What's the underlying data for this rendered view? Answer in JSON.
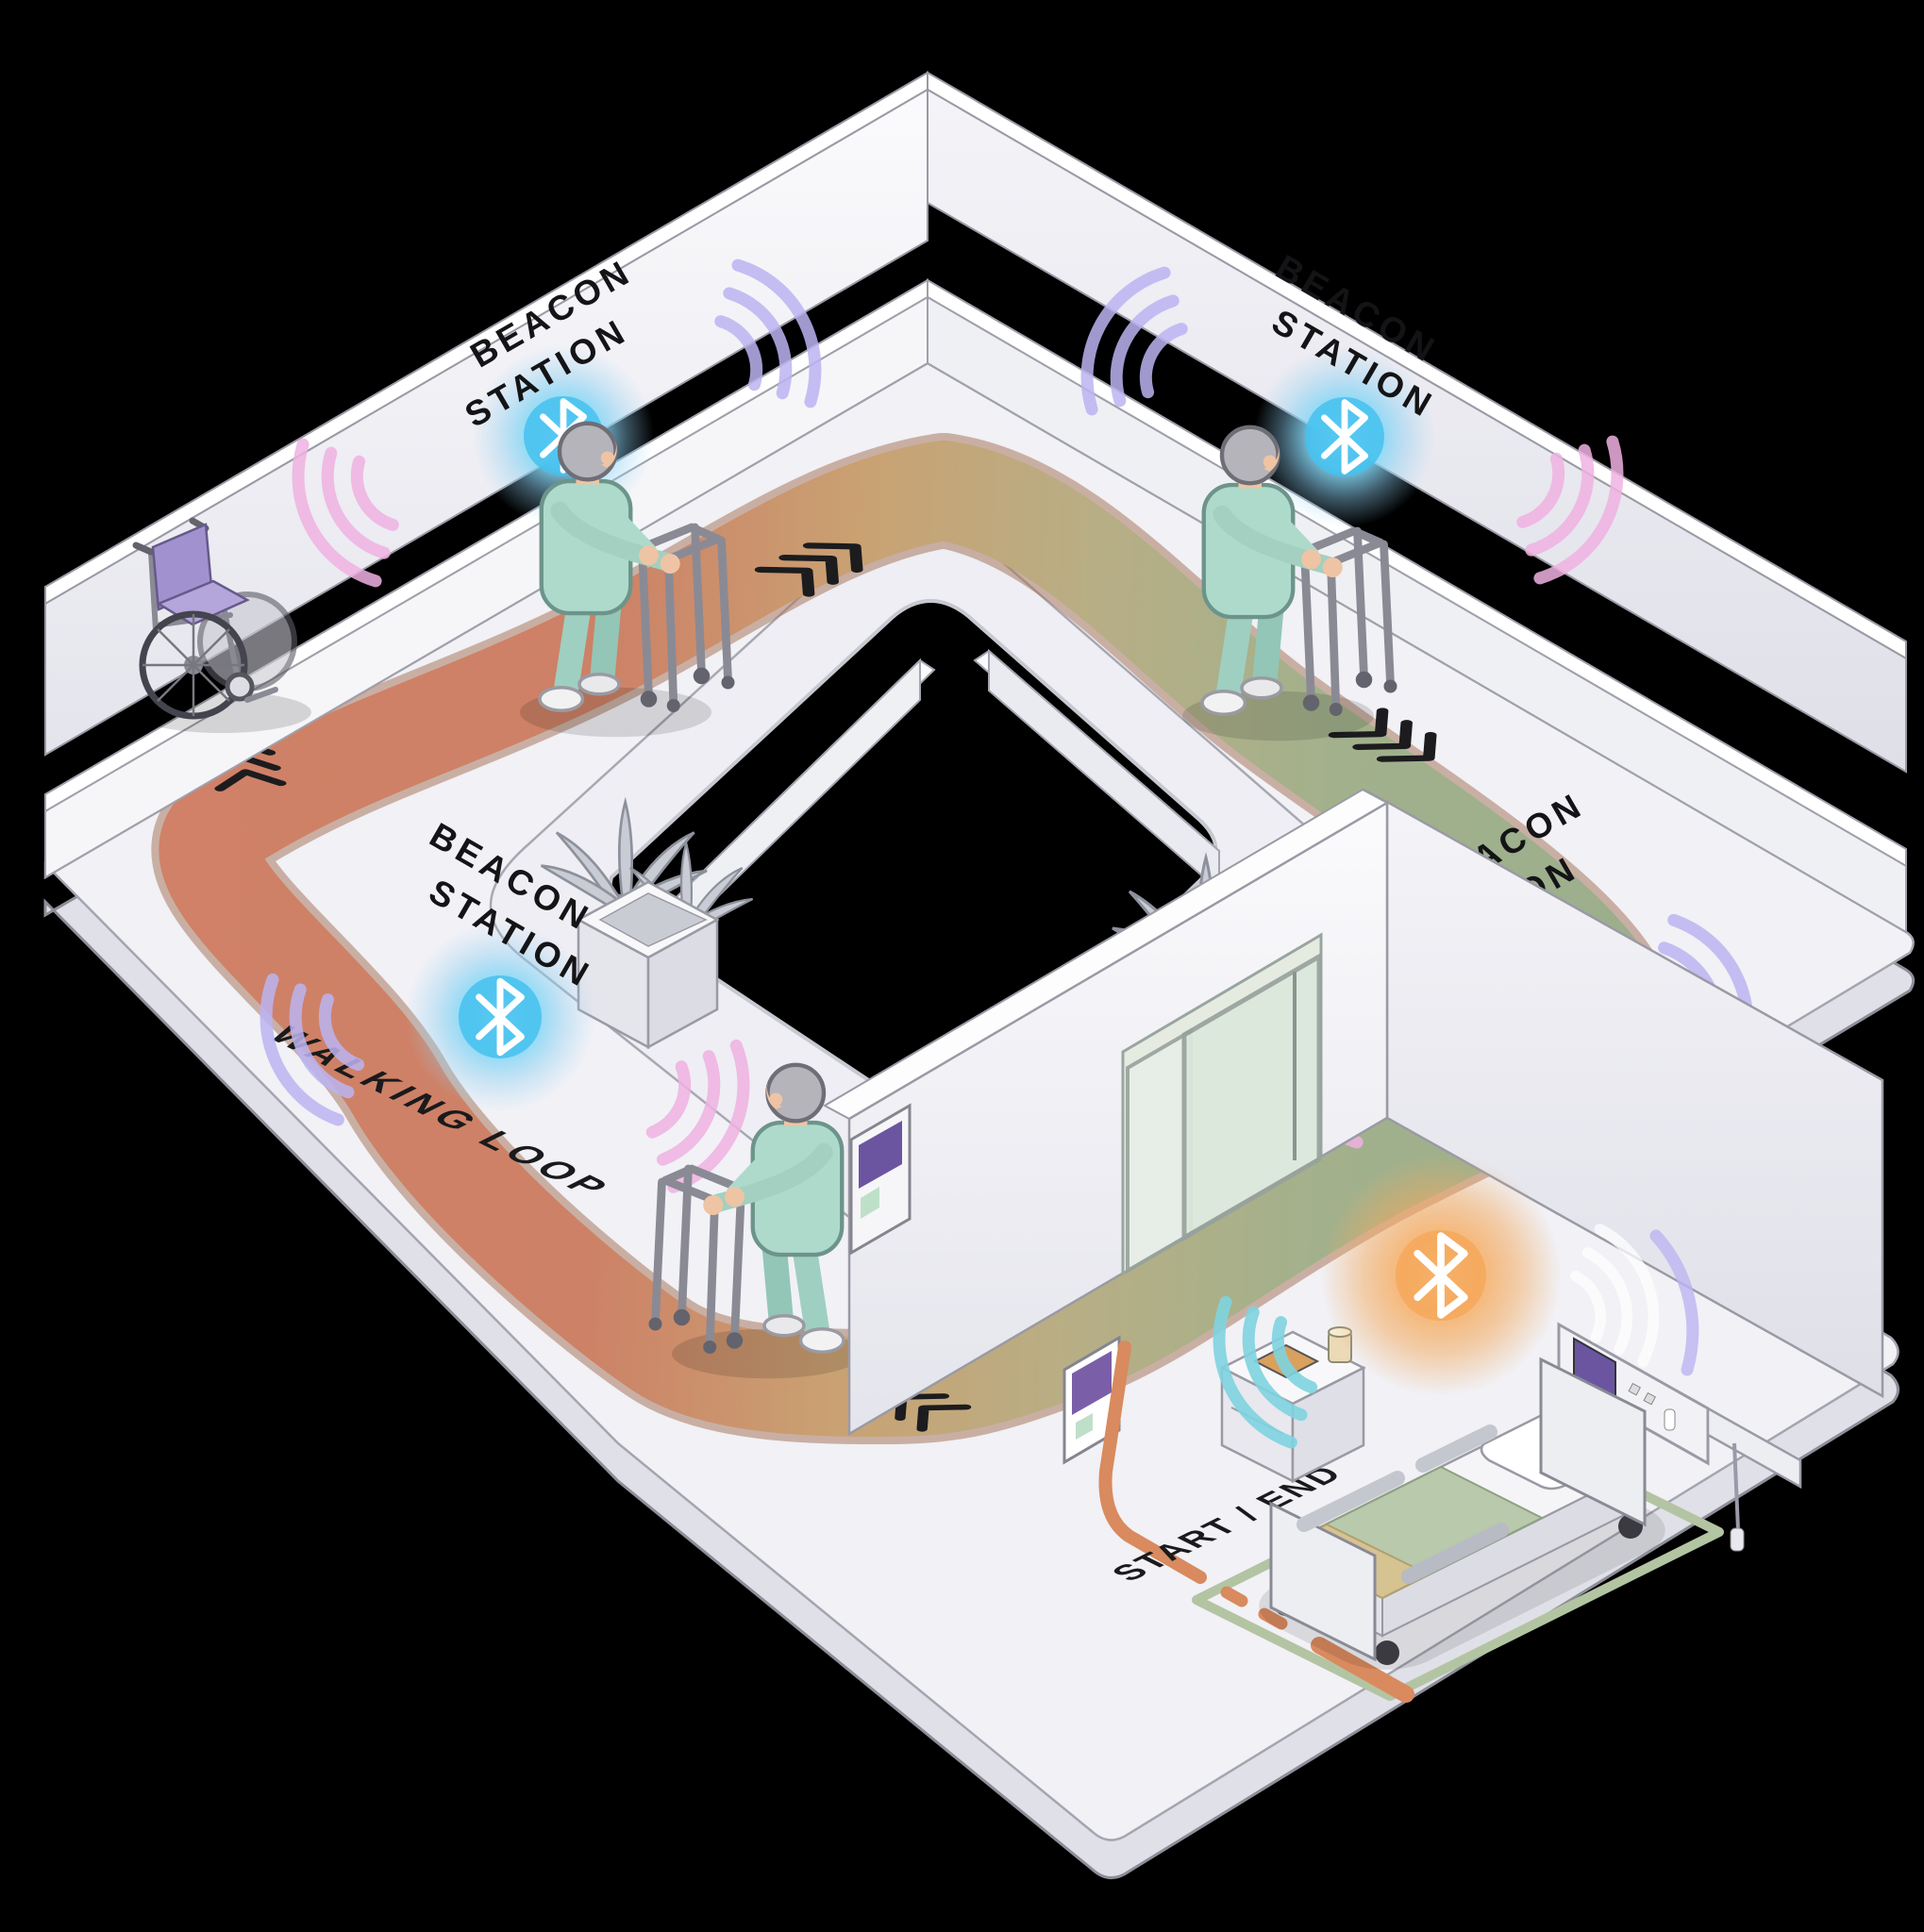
{
  "background_color": "#000000",
  "beacon_stations": [
    {
      "id": "top-left-wall",
      "label_line1": "BEACON",
      "label_line2": "STATION",
      "icon": "bluetooth-icon",
      "glow_color": "#54c6ef"
    },
    {
      "id": "top-right-wall",
      "label_line1": "BEACON",
      "label_line2": "STATION",
      "icon": "bluetooth-icon",
      "glow_color": "#54c6ef"
    },
    {
      "id": "mid-left-floor",
      "label_line1": "BEACON",
      "label_line2": "STATION",
      "icon": "bluetooth-icon",
      "glow_color": "#54c6ef"
    },
    {
      "id": "mid-right-floor",
      "label_line1": "BEACON",
      "label_line2": "STATION",
      "icon": "bluetooth-icon",
      "glow_color": "#54c6ef"
    }
  ],
  "track": {
    "label": "WALKING LOOP",
    "color_left": "#cf8065",
    "color_mid": "#c7a06e",
    "color_right": "#9cae8d",
    "direction_markers": "chevron-arrows"
  },
  "room": {
    "floor_label": "START / END",
    "beacon": {
      "icon": "bluetooth-icon",
      "glow_color": "#f2a95e"
    },
    "floor_outline_color": "#b3c4a3",
    "floor_path_color": "#d98a5e",
    "kiosk_screen_color": "#6b55a0"
  },
  "figures": {
    "patients_with_walkers": 3,
    "wheelchairs": 1,
    "hospital_beds": 1,
    "planters": 2
  },
  "palette": {
    "wall": "#f1f1f6",
    "scrubs_teal": "#aedacb",
    "wheelchair_purple": "#a291cf",
    "waves_pink": "#f0b2e2",
    "waves_purple": "#bcb4f2",
    "waves_cyan": "#8fd8e8",
    "bed_blanket_green": "#b9c9ab",
    "bed_blanket_tan": "#d6c392"
  }
}
